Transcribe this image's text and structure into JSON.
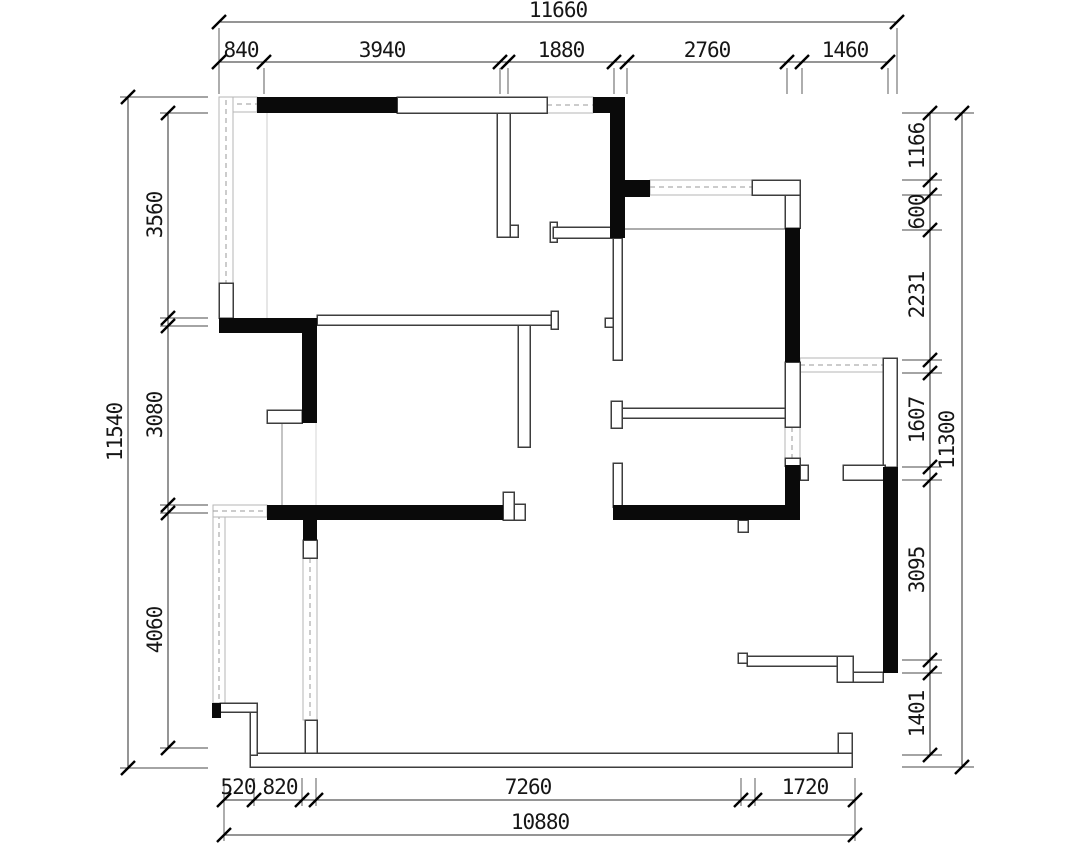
{
  "drawing": {
    "type": "architectural-floor-plan",
    "units": "mm",
    "dimensions": {
      "top": {
        "overall": "11660",
        "segments": [
          "840",
          "3940",
          "1880",
          "2760",
          "1460"
        ]
      },
      "left": {
        "overall": "11540",
        "segments": [
          "3560",
          "3080",
          "4060"
        ]
      },
      "right": {
        "overall": "11300",
        "segments": [
          "1166",
          "600",
          "2231",
          "1607",
          "3095",
          "1401"
        ]
      },
      "bottom": {
        "overall": "10880",
        "segments": [
          "520",
          "820",
          "7260",
          "1720"
        ]
      }
    },
    "colors": {
      "background": "#ffffff",
      "wall_fill": "#0a0a0a",
      "wall_outline": "#3d3d3d",
      "window_dash": "#9a9a9a",
      "dimension_line": "#2b2b2b"
    }
  }
}
